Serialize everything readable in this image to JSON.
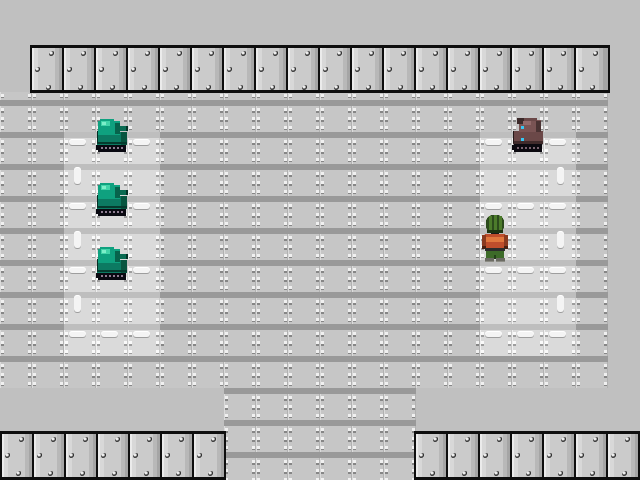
{
  "scene": {
    "background_color": "#c0c0c0",
    "palette": {
      "floor_face": "#c6c6c6",
      "floor_band": "#999999",
      "floor_light_face": "#dadada",
      "floor_light_band": "#bebebe",
      "wall_face": "#cbcbcb",
      "wall_border": "#0e0e0e",
      "marking_white": "#f4f4f4"
    },
    "grid": {
      "tile_w": 32,
      "tile_h": 32,
      "origin_x": 0,
      "origin_y": 100
    },
    "regions": [
      {
        "name": "floor-main",
        "kind": "floor",
        "x": 0,
        "y": 92,
        "w": 608,
        "h": 296
      },
      {
        "name": "floor-extension",
        "kind": "floor",
        "x": 224,
        "y": 388,
        "w": 192,
        "h": 92
      },
      {
        "name": "parking-pad-left",
        "kind": "floor-light",
        "x": 64,
        "y": 132,
        "w": 96,
        "h": 224
      },
      {
        "name": "parking-pad-right",
        "kind": "floor-light",
        "x": 480,
        "y": 132,
        "w": 96,
        "h": 224
      },
      {
        "name": "wall-top",
        "kind": "wall",
        "x": 30,
        "y": 45,
        "w": 580,
        "h": 48,
        "panels": 18
      },
      {
        "name": "wall-bottom-left",
        "kind": "wall",
        "x": 0,
        "y": 431,
        "w": 226,
        "h": 49,
        "panels": 7
      },
      {
        "name": "wall-bottom-right",
        "kind": "wall",
        "x": 414,
        "y": 431,
        "w": 226,
        "h": 49,
        "panels": 7
      }
    ],
    "rivet_offsets": [
      [
        17,
        3
      ],
      [
        3,
        19
      ],
      [
        14,
        37
      ]
    ],
    "markings": [
      {
        "dir": "h",
        "x": 69,
        "y": 139,
        "w": 17,
        "h": 6
      },
      {
        "dir": "h",
        "x": 101,
        "y": 139,
        "w": 17,
        "h": 6
      },
      {
        "dir": "h",
        "x": 133,
        "y": 139,
        "w": 17,
        "h": 6
      },
      {
        "dir": "h",
        "x": 485,
        "y": 139,
        "w": 17,
        "h": 6
      },
      {
        "dir": "h",
        "x": 517,
        "y": 139,
        "w": 17,
        "h": 6
      },
      {
        "dir": "h",
        "x": 549,
        "y": 139,
        "w": 17,
        "h": 6
      },
      {
        "dir": "h",
        "x": 69,
        "y": 203,
        "w": 17,
        "h": 6
      },
      {
        "dir": "h",
        "x": 101,
        "y": 203,
        "w": 17,
        "h": 6
      },
      {
        "dir": "h",
        "x": 133,
        "y": 203,
        "w": 17,
        "h": 6
      },
      {
        "dir": "h",
        "x": 485,
        "y": 203,
        "w": 17,
        "h": 6
      },
      {
        "dir": "h",
        "x": 517,
        "y": 203,
        "w": 17,
        "h": 6
      },
      {
        "dir": "h",
        "x": 549,
        "y": 203,
        "w": 17,
        "h": 6
      },
      {
        "dir": "h",
        "x": 69,
        "y": 267,
        "w": 17,
        "h": 6
      },
      {
        "dir": "h",
        "x": 101,
        "y": 267,
        "w": 17,
        "h": 6
      },
      {
        "dir": "h",
        "x": 133,
        "y": 267,
        "w": 17,
        "h": 6
      },
      {
        "dir": "h",
        "x": 485,
        "y": 267,
        "w": 17,
        "h": 6
      },
      {
        "dir": "h",
        "x": 517,
        "y": 267,
        "w": 17,
        "h": 6
      },
      {
        "dir": "h",
        "x": 549,
        "y": 267,
        "w": 17,
        "h": 6
      },
      {
        "dir": "h",
        "x": 69,
        "y": 331,
        "w": 17,
        "h": 6
      },
      {
        "dir": "h",
        "x": 101,
        "y": 331,
        "w": 17,
        "h": 6
      },
      {
        "dir": "h",
        "x": 133,
        "y": 331,
        "w": 17,
        "h": 6
      },
      {
        "dir": "h",
        "x": 485,
        "y": 331,
        "w": 17,
        "h": 6
      },
      {
        "dir": "h",
        "x": 517,
        "y": 331,
        "w": 17,
        "h": 6
      },
      {
        "dir": "h",
        "x": 549,
        "y": 331,
        "w": 17,
        "h": 6
      },
      {
        "dir": "v",
        "x": 74,
        "y": 167,
        "w": 7,
        "h": 17
      },
      {
        "dir": "v",
        "x": 74,
        "y": 231,
        "w": 7,
        "h": 17
      },
      {
        "dir": "v",
        "x": 74,
        "y": 295,
        "w": 7,
        "h": 17
      },
      {
        "dir": "v",
        "x": 557,
        "y": 167,
        "w": 7,
        "h": 17
      },
      {
        "dir": "v",
        "x": 557,
        "y": 231,
        "w": 7,
        "h": 17
      },
      {
        "dir": "v",
        "x": 557,
        "y": 295,
        "w": 7,
        "h": 17
      }
    ],
    "sprites": [
      {
        "type": "tank-green",
        "name": "green-tank-sprite",
        "x": 95,
        "y": 117,
        "w": 34,
        "h": 36
      },
      {
        "type": "tank-green",
        "name": "green-tank-sprite",
        "x": 95,
        "y": 181,
        "w": 34,
        "h": 36
      },
      {
        "type": "tank-green",
        "name": "green-tank-sprite",
        "x": 95,
        "y": 245,
        "w": 34,
        "h": 36
      },
      {
        "type": "tank-brown",
        "name": "brown-tank-sprite",
        "x": 511,
        "y": 117,
        "w": 34,
        "h": 36
      },
      {
        "type": "player",
        "name": "player-character-sprite",
        "x": 482,
        "y": 212,
        "w": 26,
        "h": 50
      }
    ]
  }
}
